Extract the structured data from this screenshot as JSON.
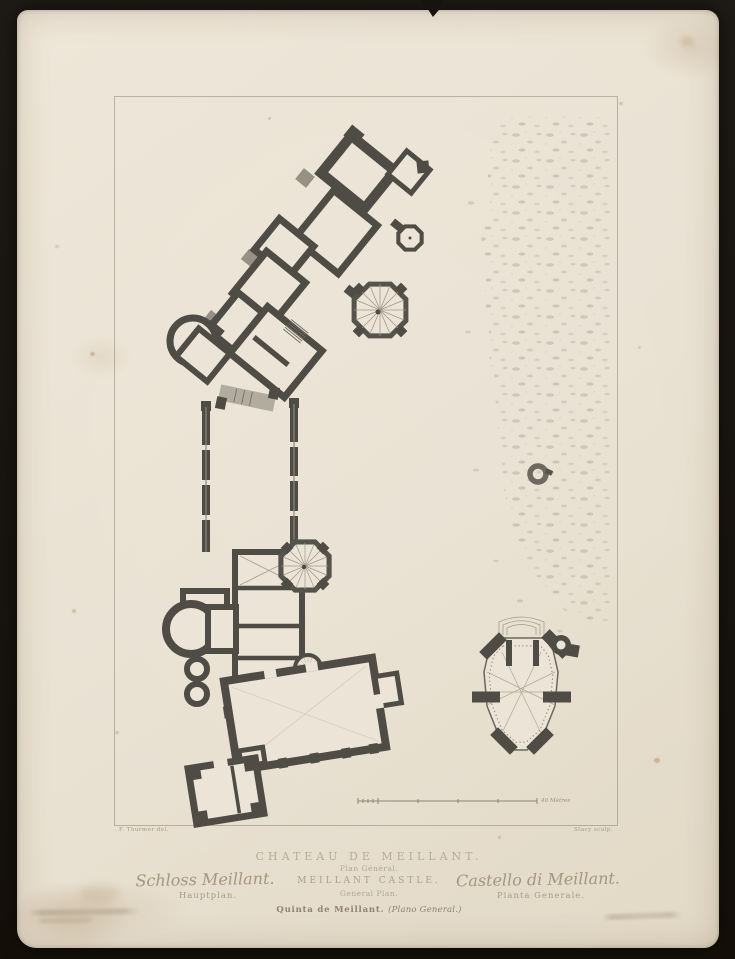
{
  "palette": {
    "scan_background": "#181410",
    "paper": "#e9e1d2",
    "wall_ink": "#4f4c45",
    "thin_ink": "#8a8476",
    "caption_ink": "#ab9f8b",
    "stipple": "#b5ae9f"
  },
  "plate": {
    "credit_left": "F. Thurmer del.",
    "credit_right": "Stacy sculp.",
    "scale_label": "40 Mètres"
  },
  "captions": {
    "french_title": "CHATEAU DE MEILLANT.",
    "french_subtitle": "Plan Général.",
    "english_title": "MEILLANT CASTLE.",
    "english_subtitle": "General Plan.",
    "german_title": "Schloss Meillant.",
    "german_subtitle": "Hauptplan.",
    "italian_title": "Castello di Meillant.",
    "italian_subtitle": "Pianta Generale.",
    "spanish_title": "Quinta de Meillant.",
    "spanish_subtitle": "(Plano General.)"
  }
}
